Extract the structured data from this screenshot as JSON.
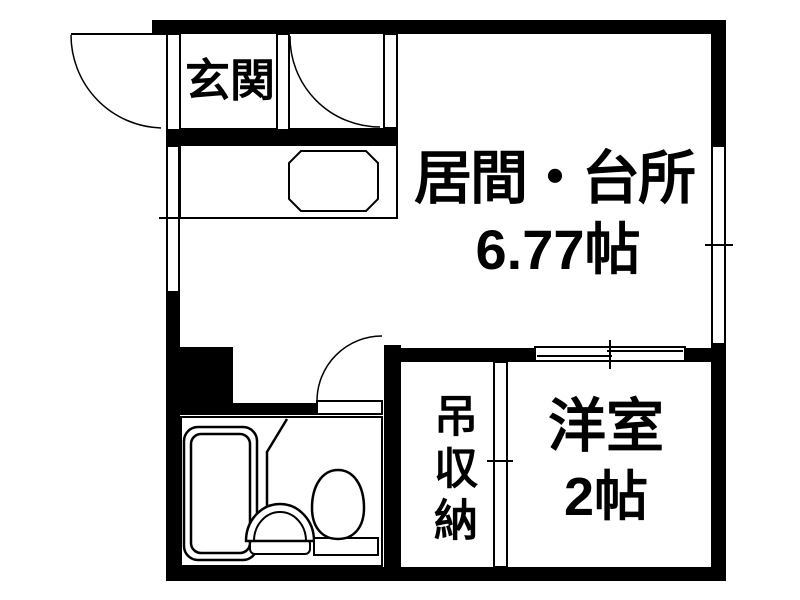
{
  "floorplan": {
    "rooms": {
      "entrance": {
        "label": "玄関"
      },
      "living_kitchen": {
        "label": "居間・台所",
        "size": "6.77帖"
      },
      "western_room": {
        "label": "洋室",
        "size": "2帖"
      },
      "hanging_storage": {
        "label": "吊収納"
      }
    },
    "colors": {
      "wall": "#000000",
      "background": "#ffffff",
      "line": "#000000"
    },
    "fixtures": [
      "bathtub",
      "washbasin",
      "toilet",
      "kitchen-sink",
      "kitchen-counter"
    ],
    "openings": [
      "entrance-door",
      "closet-door",
      "washroom-door",
      "window-left",
      "window-right",
      "window-interior"
    ]
  }
}
